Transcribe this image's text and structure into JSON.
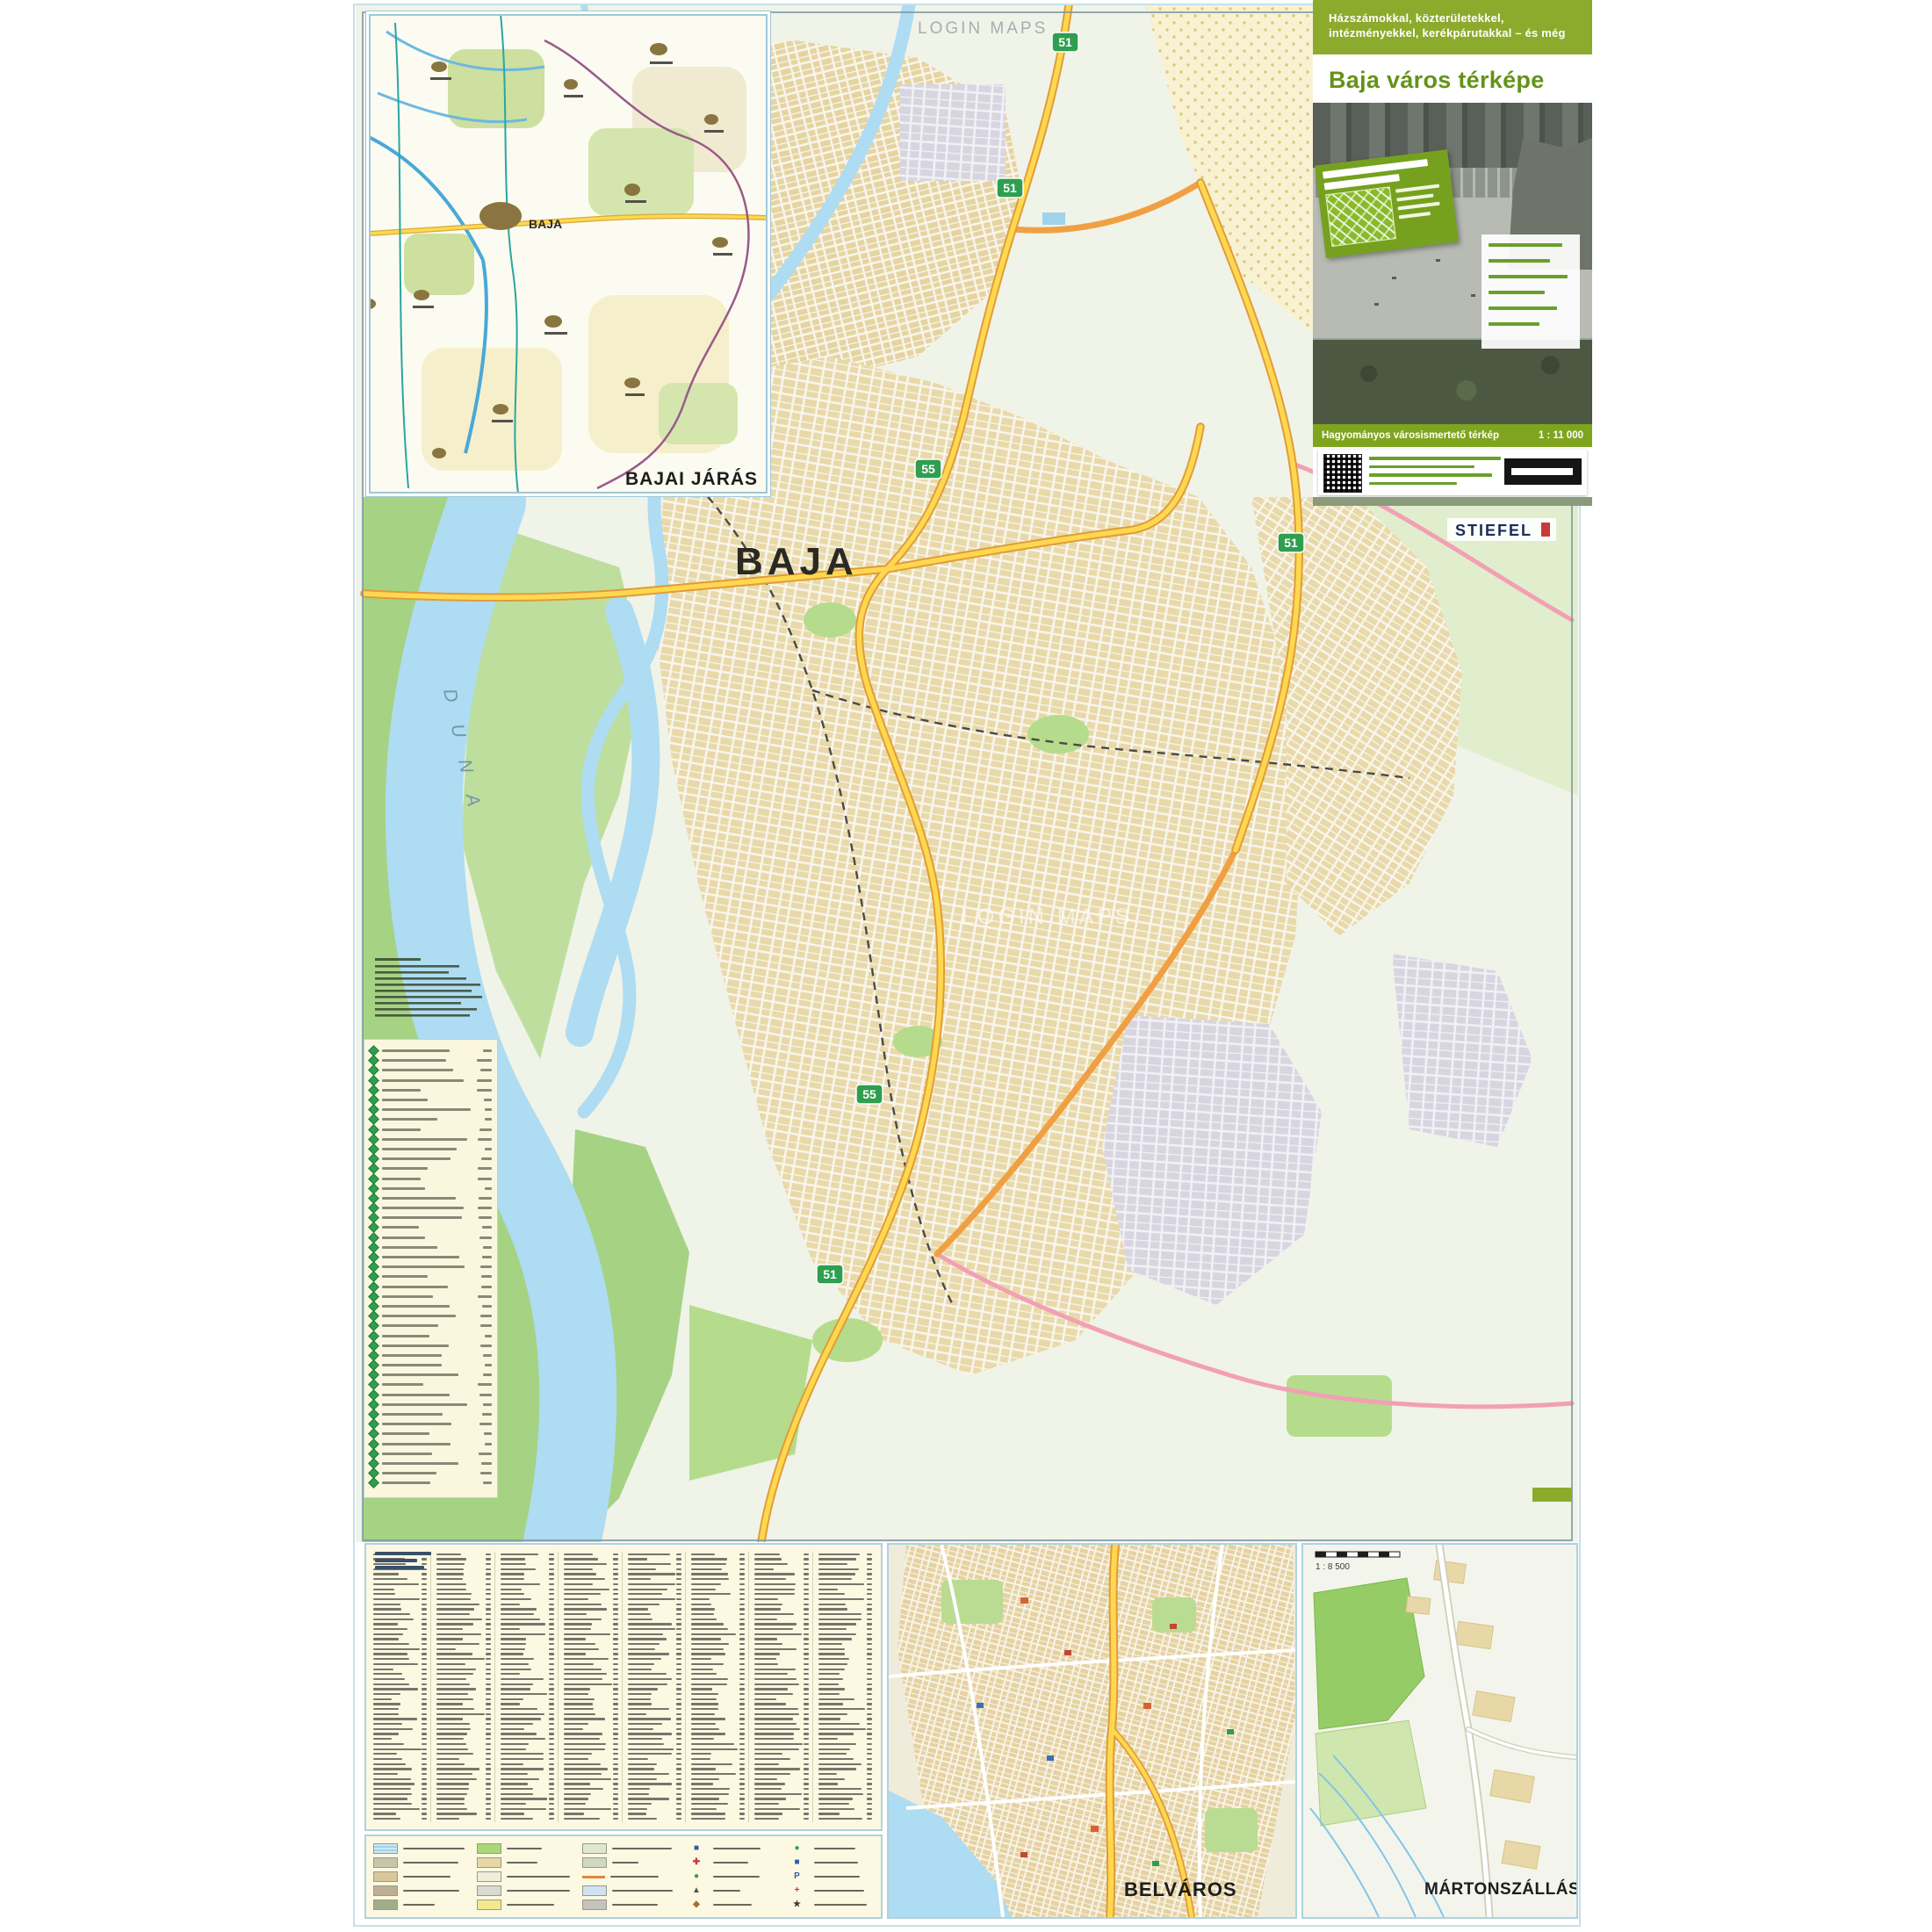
{
  "page": {
    "background": "#ffffff"
  },
  "regional_inset": {
    "label": "BAJAI JÁRÁS",
    "city": "BAJA"
  },
  "main_map": {
    "city_label": "BAJA",
    "river_label": "D U N A",
    "watermark": "LOGIN MAPS",
    "watermark2": "LOGIN MAPS",
    "publisher": "STIEFEL",
    "route_shields": [
      "51",
      "51",
      "55",
      "51",
      "55",
      "51"
    ]
  },
  "title_panel": {
    "header_line1": "Házszámokkal, közterületekkel,",
    "header_line2": "intézményekkel, kerékpárutakkal – és még",
    "title": "Baja város térképe",
    "scale_strip_left": "Hagyományos városismertető térkép",
    "scale_strip_right": "1 : 11 000"
  },
  "belvaros_inset": {
    "label": "BELVÁROS"
  },
  "martonszallas_inset": {
    "label": "MÁRTONSZÁLLÁS",
    "scale_text": "1 : 8 500"
  },
  "street_index": {
    "column_count": 8,
    "rows_per_column": 54
  },
  "poi_panel": {
    "row_count": 45
  },
  "legend": {
    "groups": [
      {
        "rows": [
          {
            "t": "water"
          },
          {
            "t": "sw",
            "c": "#c9c6a8"
          },
          {
            "t": "sw",
            "c": "#d9c79a"
          },
          {
            "t": "sw",
            "c": "#bdb096"
          },
          {
            "t": "sw",
            "c": "#9fae86"
          }
        ]
      },
      {
        "rows": [
          {
            "t": "sw",
            "c": "#a8d878"
          },
          {
            "t": "sw",
            "c": "#e8d7a6"
          },
          {
            "t": "sw",
            "c": "#f1edd9"
          },
          {
            "t": "sw",
            "c": "#dadad2"
          },
          {
            "t": "sw",
            "c": "#f3e98c"
          }
        ]
      },
      {
        "rows": [
          {
            "t": "sw",
            "c": "#dfe8cc"
          },
          {
            "t": "sw",
            "c": "#cfd8c0"
          },
          {
            "t": "line",
            "c": "#e08838"
          },
          {
            "t": "sw",
            "c": "#cfe3ee"
          },
          {
            "t": "sw",
            "c": "#c4c4bc"
          }
        ]
      },
      {
        "rows": [
          {
            "t": "sym",
            "g": "■",
            "c": "#2f5fa8"
          },
          {
            "t": "sym",
            "g": "✚",
            "c": "#c83a3a"
          },
          {
            "t": "sym",
            "g": "●",
            "c": "#2f9e4f"
          },
          {
            "t": "sym",
            "g": "▲",
            "c": "#555550"
          },
          {
            "t": "sym",
            "g": "◆",
            "c": "#a8702a"
          }
        ]
      },
      {
        "rows": [
          {
            "t": "sym",
            "g": "●",
            "c": "#2f9e4f"
          },
          {
            "t": "sym",
            "g": "■",
            "c": "#2f5fa8"
          },
          {
            "t": "sym",
            "g": "P",
            "c": "#2f5fa8"
          },
          {
            "t": "sym",
            "g": "+",
            "c": "#c83a3a"
          },
          {
            "t": "sym",
            "g": "★",
            "c": "#3a3a34"
          }
        ]
      }
    ]
  },
  "colors": {
    "water": "#aedcf2",
    "floodplain": "#a6d284",
    "park": "#b4dc8c",
    "urban_tan": "#e9d9a9",
    "industrial_gray": "#d7d5df",
    "fields_yellow": "#f8f2d2",
    "road_yellow": "#ffd84f",
    "road_casing": "#e09b38",
    "road_orange": "#f0a043",
    "road_pink": "#f2a0b4",
    "shield_green": "#2f9e4f",
    "header_green": "#8cab2d"
  }
}
